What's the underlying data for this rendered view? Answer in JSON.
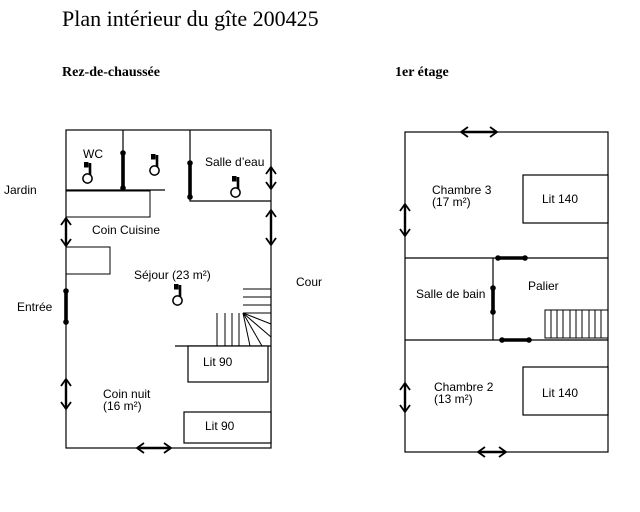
{
  "title": "Plan intérieur du gîte 200425",
  "colors": {
    "line": "#000000",
    "background": "#ffffff",
    "text": "#000000"
  },
  "icons": {
    "toilet_fixture": "toilet-icon",
    "door_opening": "door-opening-icon",
    "window": "double-arrow-window-icon",
    "stairs_ground": "winder-stairs-icon",
    "stairs_first": "straight-stairs-icon"
  },
  "floors": {
    "ground": {
      "heading": "Rez-de-chaussée",
      "labels": {
        "jardin": "Jardin",
        "entree": "Entrée",
        "cour": "Cour",
        "wc": "WC",
        "salle_deau": "Salle d’eau",
        "coin_cuisine": "Coin Cuisine",
        "sejour": "Séjour (23 m²)",
        "coin_nuit_1": "Coin nuit",
        "coin_nuit_2": "(16 m²)",
        "lit90_top": "Lit 90",
        "lit90_bottom": "Lit 90"
      }
    },
    "first": {
      "heading": "1er étage",
      "labels": {
        "chambre3_1": "Chambre 3",
        "chambre3_2": "(17 m²)",
        "lit140_top": "Lit 140",
        "salle_de_bain": "Salle de bain",
        "palier": "Palier",
        "chambre2_1": "Chambre 2",
        "chambre2_2": "(13 m²)",
        "lit140_bottom": "Lit 140"
      }
    }
  }
}
